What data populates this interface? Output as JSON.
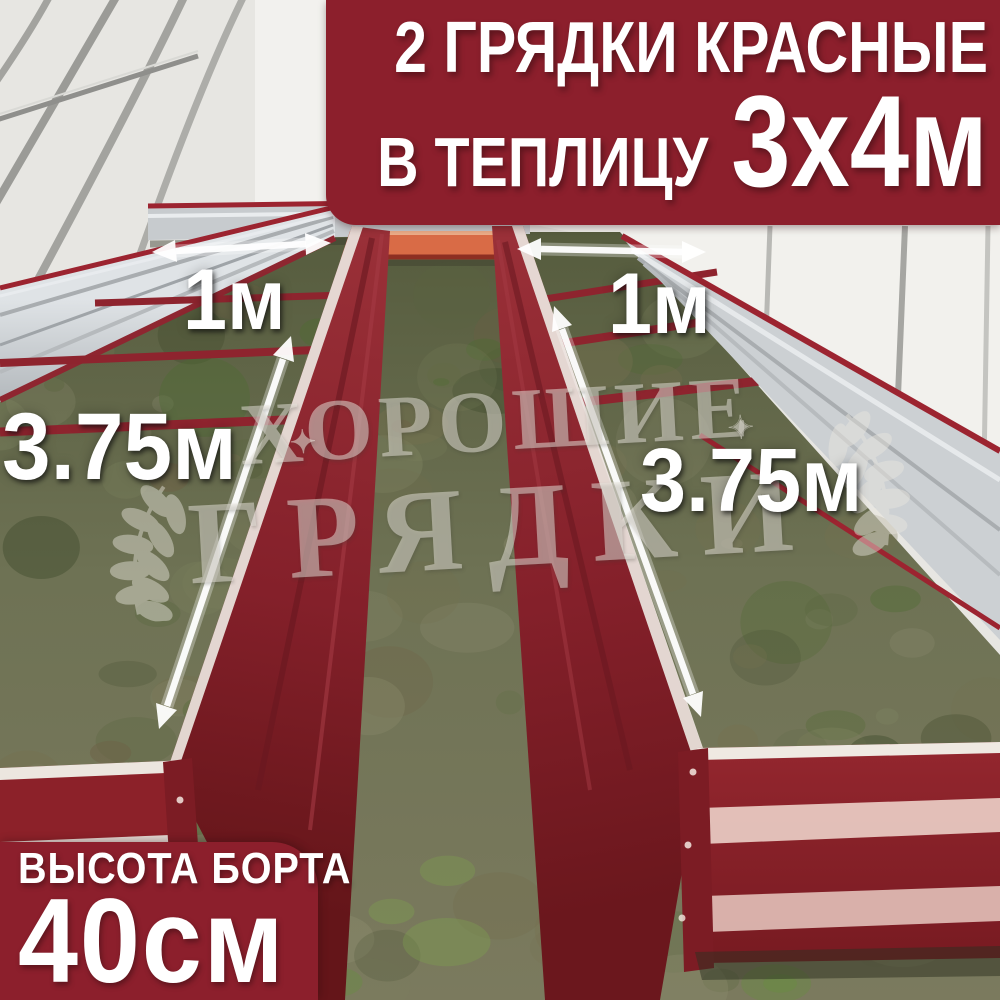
{
  "banner": {
    "line1": "2 ГРЯДКИ КРАСНЫЕ",
    "line2_prefix": "В ТЕПЛИЦУ",
    "line2_size": "3х4м"
  },
  "badge": {
    "title": "ВЫСОТА БОРТА",
    "value": "40",
    "unit": "см"
  },
  "dimensions": {
    "bed_width_left": "1м",
    "bed_width_right": "1м",
    "bed_length_left": "3.75м",
    "bed_length_right": "3.75м"
  },
  "watermark": {
    "line1": "ХОРОШИЕ",
    "line2": "ГРЯДКИ",
    "star": "✦"
  },
  "colors": {
    "accent_red": "#8c1f2c",
    "bed_red": "#8a2028",
    "bed_red_dark": "#6b171d",
    "galvanized": "#c9cdd0",
    "text": "#ffffff",
    "soil_olive": "#6e7254"
  }
}
